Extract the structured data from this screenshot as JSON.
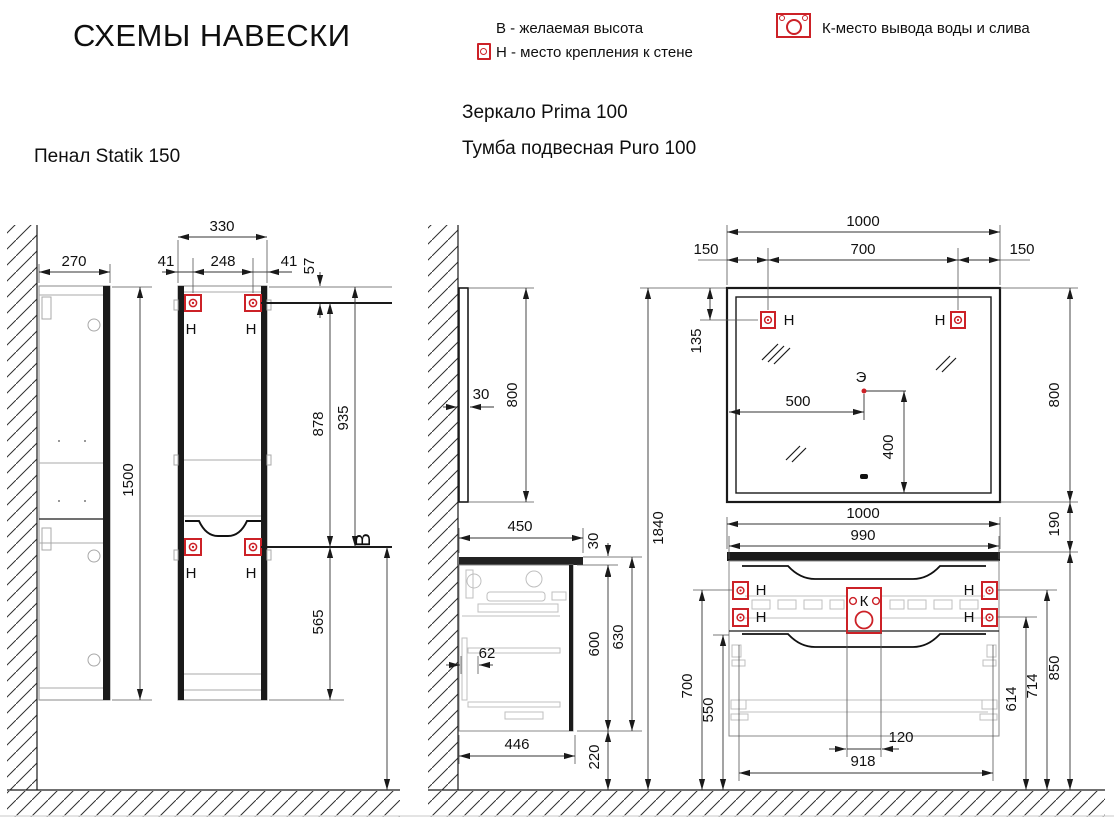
{
  "title": "СХЕМЫ НАВЕСКИ",
  "legend": {
    "desired_height": "В - желаемая высота",
    "wall_mount": "Н - место крепления к стене",
    "water_drain": "К-место вывода воды и слива"
  },
  "markers": {
    "h": "Н",
    "k": "К",
    "e": "Э",
    "b": "В"
  },
  "colors": {
    "marker_red": "#cc2127",
    "line_black": "#1a1a1a",
    "detail_gray": "#b0b0b0"
  },
  "pencil": {
    "label": "Пенал Statik 150",
    "dims": {
      "side_depth": "270",
      "height": "1500",
      "front_width": "330",
      "edge_to_hole_left": "41",
      "holes_span": "248",
      "edge_to_hole_right": "41",
      "top_to_holes": "57",
      "between_hole_rows": "878",
      "top_to_lower_holes": "935",
      "lower_holes_to_bottom": "565"
    }
  },
  "mirror": {
    "label": "Зеркало Prima 100",
    "dims": {
      "depth": "30",
      "height": "800",
      "width": "1000",
      "edge_to_hole_left": "150",
      "holes_span": "700",
      "edge_to_hole_right": "150",
      "top_to_holes": "135",
      "electric_from_left": "500",
      "electric_from_bottom": "400"
    }
  },
  "vanity": {
    "label": "Тумба подвесная Puro 100",
    "dims": {
      "side_depth": "450",
      "counter_thickness": "30",
      "body_height": "600",
      "total_height": "630",
      "inner_offset": "62",
      "body_depth": "446",
      "under_clearance": "220",
      "overall_height": "1840",
      "counter_width": "1000",
      "body_width": "990",
      "mirror_gap": "190",
      "upper_holes_left": "700",
      "lower_edge_left": "550",
      "drain_zone_width": "120",
      "holes_span": "918",
      "lower_holes_right": "614",
      "upper_holes_right": "714",
      "counter_top_height": "850"
    }
  }
}
